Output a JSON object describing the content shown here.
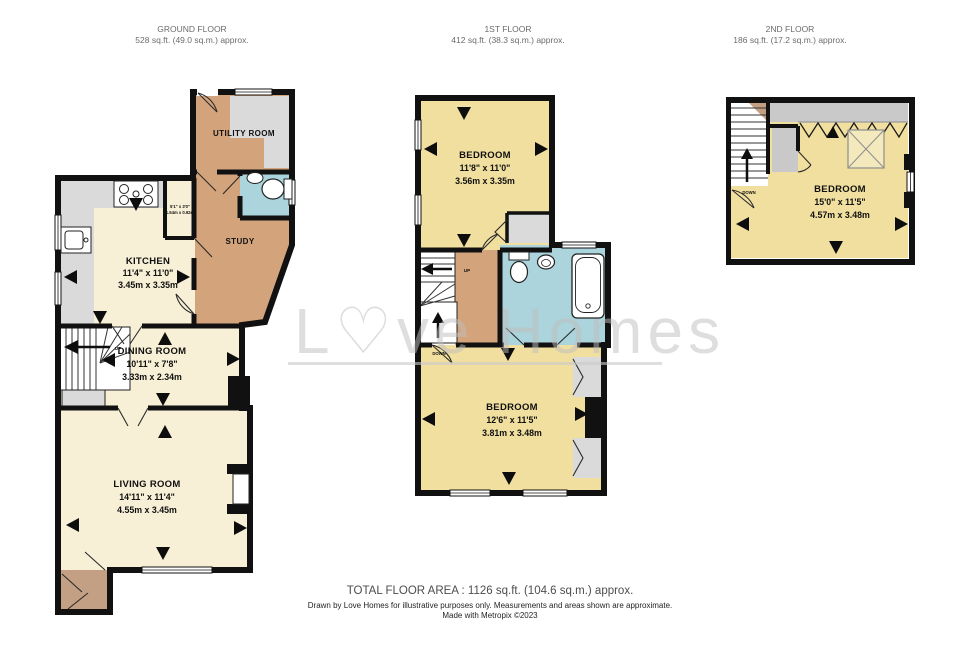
{
  "colors": {
    "wall": "#111111",
    "room_cream": "#f7f0d6",
    "room_yellow": "#f1df9f",
    "hall_tan": "#d3a47c",
    "porch_brown": "#c3a083",
    "bathroom_blue": "#abd4dc",
    "fitting_grey": "#dadada",
    "watermark_grey": "#c9c9c9"
  },
  "floors": {
    "ground": {
      "title": "GROUND FLOOR",
      "area": "528 sq.ft. (49.0 sq.m.) approx.",
      "stairs_up_label": "UP",
      "rooms": {
        "utility": {
          "name": "UTILITY ROOM"
        },
        "study": {
          "name": "STUDY"
        },
        "kitchen": {
          "name": "KITCHEN",
          "dims_ft": "11'4\"  x 11'0\"",
          "dims_m": "3.45m  x 3.35m"
        },
        "lobby": {
          "dims_ft": "5'1\" x 3'0\"",
          "dims_m": "1.54m x 0.92m"
        },
        "dining": {
          "name": "DINING ROOM",
          "dims_ft": "10'11\"  x 7'8\"",
          "dims_m": "3.33m  x 2.34m"
        },
        "living": {
          "name": "LIVING ROOM",
          "dims_ft": "14'11\"  x 11'4\"",
          "dims_m": "4.55m  x 3.45m"
        }
      }
    },
    "first": {
      "title": "1ST FLOOR",
      "area": "412 sq.ft. (38.3 sq.m.) approx.",
      "stairs_up_label": "UP",
      "stairs_down_label": "DOWN",
      "rooms": {
        "bedroom_front": {
          "name": "BEDROOM",
          "dims_ft": "11'8\"  x 11'0\"",
          "dims_m": "3.56m  x 3.35m"
        },
        "bedroom_back": {
          "name": "BEDROOM",
          "dims_ft": "12'6\"  x 11'5\"",
          "dims_m": "3.81m  x 3.48m"
        }
      }
    },
    "second": {
      "title": "2ND FLOOR",
      "area": "186 sq.ft. (17.2 sq.m.) approx.",
      "stairs_down_label": "DOWN",
      "rooms": {
        "bedroom_top": {
          "name": "BEDROOM",
          "dims_ft": "15'0\"  x 11'5\"",
          "dims_m": "4.57m  x 3.48m"
        }
      }
    }
  },
  "watermark": {
    "text": "L♡ve Homes"
  },
  "footer": {
    "total": "TOTAL FLOOR AREA : 1126 sq.ft. (104.6 sq.m.) approx.",
    "disclaimer": "Drawn by Love Homes for illustrative purposes only. Measurements and areas shown are approximate.",
    "credit": "Made with Metropix ©2023"
  }
}
